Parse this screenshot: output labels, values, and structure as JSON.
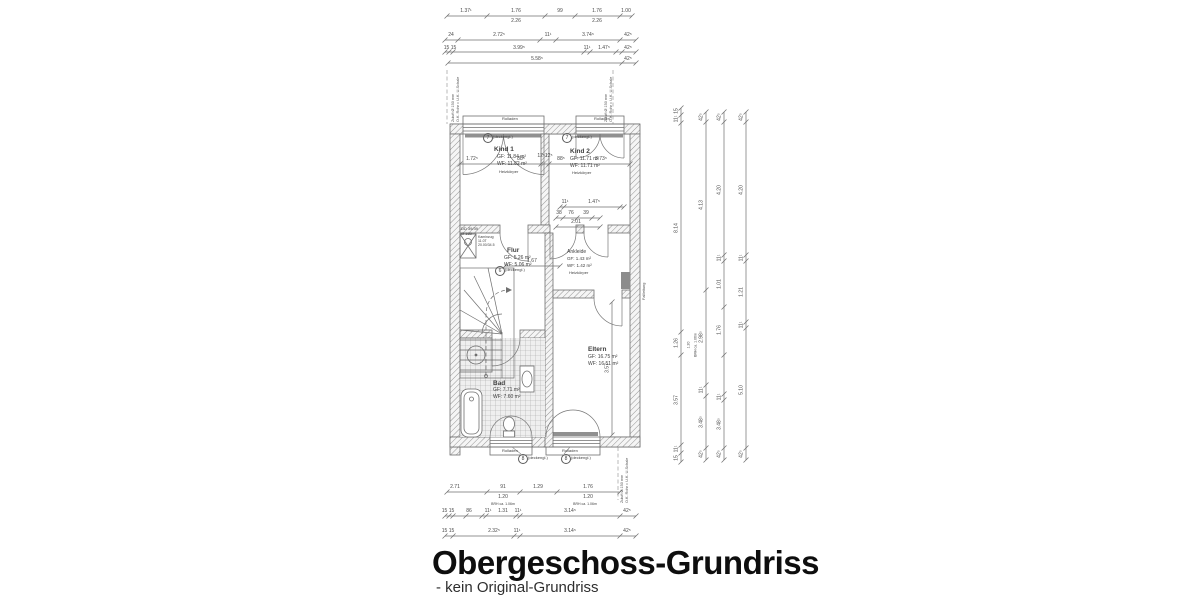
{
  "title": {
    "heading": "Obergeschoss-Grundriss",
    "subtitle": "- kein Original-Grundriss"
  },
  "rooms": {
    "kind1": {
      "name": "Kind 1",
      "gf": "GF: 11.84 m²",
      "wf": "WF: 11.82 m²",
      "sub": "Heizkörper"
    },
    "kind2": {
      "name": "Kind 2",
      "gf": "GF: 11.71 m²",
      "wf": "WF: 11.71 m²",
      "sub": "Heizkörper"
    },
    "flur": {
      "name": "Flur",
      "gf": "GF: 5.26 m²",
      "wf": "WF: 5.06 m²"
    },
    "ankleide": {
      "name": "Ankleide",
      "gf": "GF: 1.43 m²",
      "wf": "WF: 1.42 m²",
      "sub": "Heizkörper"
    },
    "bad": {
      "name": "Bad",
      "gf": "GF: 7.71 m²",
      "wf": "WF: 7.60 m²"
    },
    "eltern": {
      "name": "Eltern",
      "gf": "GF: 16.75 m²",
      "wf": "WF: 16.51 m²"
    }
  },
  "chimney": {
    "l1": "DD 39/39",
    "l2": "Ø 160",
    "n1": "Kaminzug",
    "n2": "11.0T",
    "n3": "20.00/34.5"
  },
  "windows": {
    "rolladen": "Rolladen",
    "top_marker": {
      "num": "7",
      "note": "(deckengl.)"
    },
    "bottom_marker": {
      "num": "8",
      "note": "(deckengl.)"
    },
    "flur_marker": {
      "num": "6",
      "note": "(deckengl.)"
    }
  },
  "annotations": {
    "zuluft1": "Zuluft Ø 150 mm",
    "zuluft2": "O.K. Rohr = U.K. U-Schale",
    "fall": "Fallleitung"
  },
  "dimensions": {
    "h": [
      {
        "y": 16,
        "x1": 447,
        "x2": 632,
        "ticks": [
          447,
          487,
          545,
          575,
          620,
          632
        ],
        "labels": [
          {
            "x": 466,
            "t": "1.37¹"
          },
          {
            "x": 516,
            "t": "1.76"
          },
          {
            "x": 516,
            "t": "2.26",
            "dy": 3
          },
          {
            "x": 560,
            "t": "99"
          },
          {
            "x": 597,
            "t": "1.76"
          },
          {
            "x": 597,
            "t": "2.26",
            "dy": 3
          },
          {
            "x": 626,
            "t": "1.00"
          }
        ]
      },
      {
        "y": 40,
        "x1": 445,
        "x2": 636,
        "ticks": [
          445,
          458,
          540,
          556,
          620,
          636
        ],
        "labels": [
          {
            "x": 451,
            "t": "24"
          },
          {
            "x": 499,
            "t": "2.72⁵"
          },
          {
            "x": 548,
            "t": "11¹"
          },
          {
            "x": 588,
            "t": "3.74⁵"
          },
          {
            "x": 628,
            "t": "42⁵"
          }
        ]
      },
      {
        "y": 52,
        "x1": 445,
        "x2": 636,
        "ticks": [
          445,
          449,
          453,
          584,
          590,
          616,
          622,
          636
        ],
        "labels": [
          {
            "x": 450,
            "t": "15 15",
            "dy": -6
          },
          {
            "x": 519,
            "t": "3.99⁵",
            "dy": -6
          },
          {
            "x": 587,
            "t": "11¹",
            "dy": -6
          },
          {
            "x": 604,
            "t": "1.47⁵",
            "dy": -6
          },
          {
            "x": 628,
            "t": "42⁵",
            "dy": -6
          }
        ]
      },
      {
        "y": 63,
        "x1": 448,
        "x2": 636,
        "ticks": [
          448,
          622,
          636
        ],
        "labels": [
          {
            "x": 537,
            "t": "5.58⁵",
            "dy": -6
          },
          {
            "x": 628,
            "t": "42⁵",
            "dy": -6
          }
        ]
      },
      {
        "y": 492,
        "x1": 447,
        "x2": 620,
        "ticks": [
          447,
          487,
          520,
          557,
          620
        ],
        "labels": [
          {
            "x": 455,
            "t": "2.71"
          },
          {
            "x": 503,
            "t": "91"
          },
          {
            "x": 503,
            "t": "1.20",
            "dy": 3
          },
          {
            "x": 538,
            "t": "1.29"
          },
          {
            "x": 588,
            "t": "1.76"
          },
          {
            "x": 588,
            "t": "1.20",
            "dy": 3
          }
        ]
      },
      {
        "y": 516,
        "x1": 445,
        "x2": 636,
        "ticks": [
          445,
          449,
          453,
          466,
          482,
          486,
          516,
          520,
          620,
          636
        ],
        "labels": [
          {
            "x": 448,
            "t": "15 15"
          },
          {
            "x": 469,
            "t": "86"
          },
          {
            "x": 488,
            "t": "11¹"
          },
          {
            "x": 503,
            "t": "1.31"
          },
          {
            "x": 518,
            "t": "11¹"
          },
          {
            "x": 570,
            "t": "3.14⁵"
          },
          {
            "x": 627,
            "t": "42⁵"
          }
        ]
      },
      {
        "y": 536,
        "x1": 445,
        "x2": 636,
        "ticks": [
          445,
          453,
          514,
          520,
          620,
          636
        ],
        "labels": [
          {
            "x": 448,
            "t": "15 15"
          },
          {
            "x": 494,
            "t": "2.32⁵"
          },
          {
            "x": 517,
            "t": "11¹"
          },
          {
            "x": 570,
            "t": "3.14⁵"
          },
          {
            "x": 627,
            "t": "42⁵"
          }
        ]
      },
      {
        "y": 164,
        "x1": 460,
        "x2": 630,
        "ticks": [
          460,
          541,
          549,
          630
        ],
        "labels": [
          {
            "x": 472,
            "t": "1.72⁵"
          },
          {
            "x": 521,
            "t": "88⁵"
          },
          {
            "x": 545,
            "t": "12⁵12⁵",
            "dy": -10
          },
          {
            "x": 561,
            "t": "88⁵"
          },
          {
            "x": 601,
            "t": "3.73⁵"
          }
        ]
      },
      {
        "y": 207,
        "x1": 560,
        "x2": 624,
        "ticks": [
          560,
          564,
          620,
          624
        ],
        "labels": [
          {
            "x": 565,
            "t": "11¹"
          },
          {
            "x": 594,
            "t": "1.47⁵"
          }
        ]
      },
      {
        "y": 218,
        "x1": 556,
        "x2": 600,
        "ticks": [
          556,
          563,
          577,
          592,
          600
        ],
        "labels": [
          {
            "x": 559,
            "t": "38"
          },
          {
            "x": 571,
            "t": "76"
          },
          {
            "x": 586,
            "t": "39"
          }
        ]
      },
      {
        "y": 227,
        "x1": 556,
        "x2": 600,
        "ticks": [
          556,
          600
        ],
        "labels": [
          {
            "x": 576,
            "t": "2.01"
          }
        ]
      },
      {
        "y": 266,
        "x1": 505,
        "x2": 560,
        "ticks": [
          505,
          560
        ],
        "labels": [
          {
            "x": 532,
            "t": "1.67"
          }
        ]
      }
    ],
    "v": [
      {
        "x": 681,
        "y1": 108,
        "y2": 462,
        "ticks": [
          108,
          115,
          123,
          332,
          355,
          445,
          453,
          462
        ],
        "labels": [
          {
            "y": 111,
            "t": "15"
          },
          {
            "y": 119,
            "t": "11¹"
          },
          {
            "y": 228,
            "t": "8.14"
          },
          {
            "y": 343,
            "t": "1.26"
          },
          {
            "y": 400,
            "t": "3.57"
          },
          {
            "y": 449,
            "t": "11¹"
          },
          {
            "y": 458,
            "t": "15"
          }
        ]
      },
      {
        "x": 706,
        "y1": 112,
        "y2": 460,
        "ticks": [
          112,
          122,
          290,
          385,
          396,
          448,
          460
        ],
        "labels": [
          {
            "y": 117,
            "t": "42⁵"
          },
          {
            "y": 205,
            "t": "4.13"
          },
          {
            "y": 337,
            "t": "2.98⁵"
          },
          {
            "y": 390,
            "t": "11¹"
          },
          {
            "y": 422,
            "t": "3.48⁵"
          },
          {
            "y": 454,
            "t": "42⁵"
          }
        ]
      },
      {
        "x": 724,
        "y1": 112,
        "y2": 460,
        "ticks": [
          112,
          122,
          255,
          261,
          307,
          355,
          394,
          400,
          448,
          460
        ],
        "labels": [
          {
            "y": 117,
            "t": "42⁵"
          },
          {
            "y": 190,
            "t": "4.20"
          },
          {
            "y": 258,
            "t": "11¹"
          },
          {
            "y": 284,
            "t": "1.01"
          },
          {
            "y": 330,
            "t": "1.76"
          },
          {
            "y": 397,
            "t": "11¹"
          },
          {
            "y": 424,
            "t": "3.48⁵"
          },
          {
            "y": 454,
            "t": "42⁵"
          }
        ]
      },
      {
        "x": 746,
        "y1": 112,
        "y2": 460,
        "ticks": [
          112,
          122,
          255,
          261,
          322,
          328,
          448,
          460
        ],
        "labels": [
          {
            "y": 117,
            "t": "42⁵"
          },
          {
            "y": 190,
            "t": "4.20"
          },
          {
            "y": 258,
            "t": "11¹"
          },
          {
            "y": 292,
            "t": "1.21"
          },
          {
            "y": 325,
            "t": "11¹"
          },
          {
            "y": 390,
            "t": "5.10"
          },
          {
            "y": 454,
            "t": "42⁵"
          }
        ]
      },
      {
        "x": 612,
        "y1": 302,
        "y2": 435,
        "ticks": [
          302,
          435
        ],
        "labels": [
          {
            "y": 368,
            "t": "3.57"
          }
        ]
      }
    ],
    "notes": [
      {
        "x": 503,
        "y": 503,
        "t": "BRH ca. 1.06m"
      },
      {
        "x": 585,
        "y": 503,
        "t": "BRH ca. 1.06m"
      },
      {
        "x": 689,
        "y": 345,
        "t": "1.20",
        "rot": 1
      },
      {
        "x": 696,
        "y": 345,
        "t": "BRH ca. 1.06m",
        "rot": 1
      }
    ]
  },
  "colors": {
    "line": "#6f6f6f",
    "hatch": "#949494",
    "text": "#3f3f3f",
    "title": "#0e0e0e"
  }
}
